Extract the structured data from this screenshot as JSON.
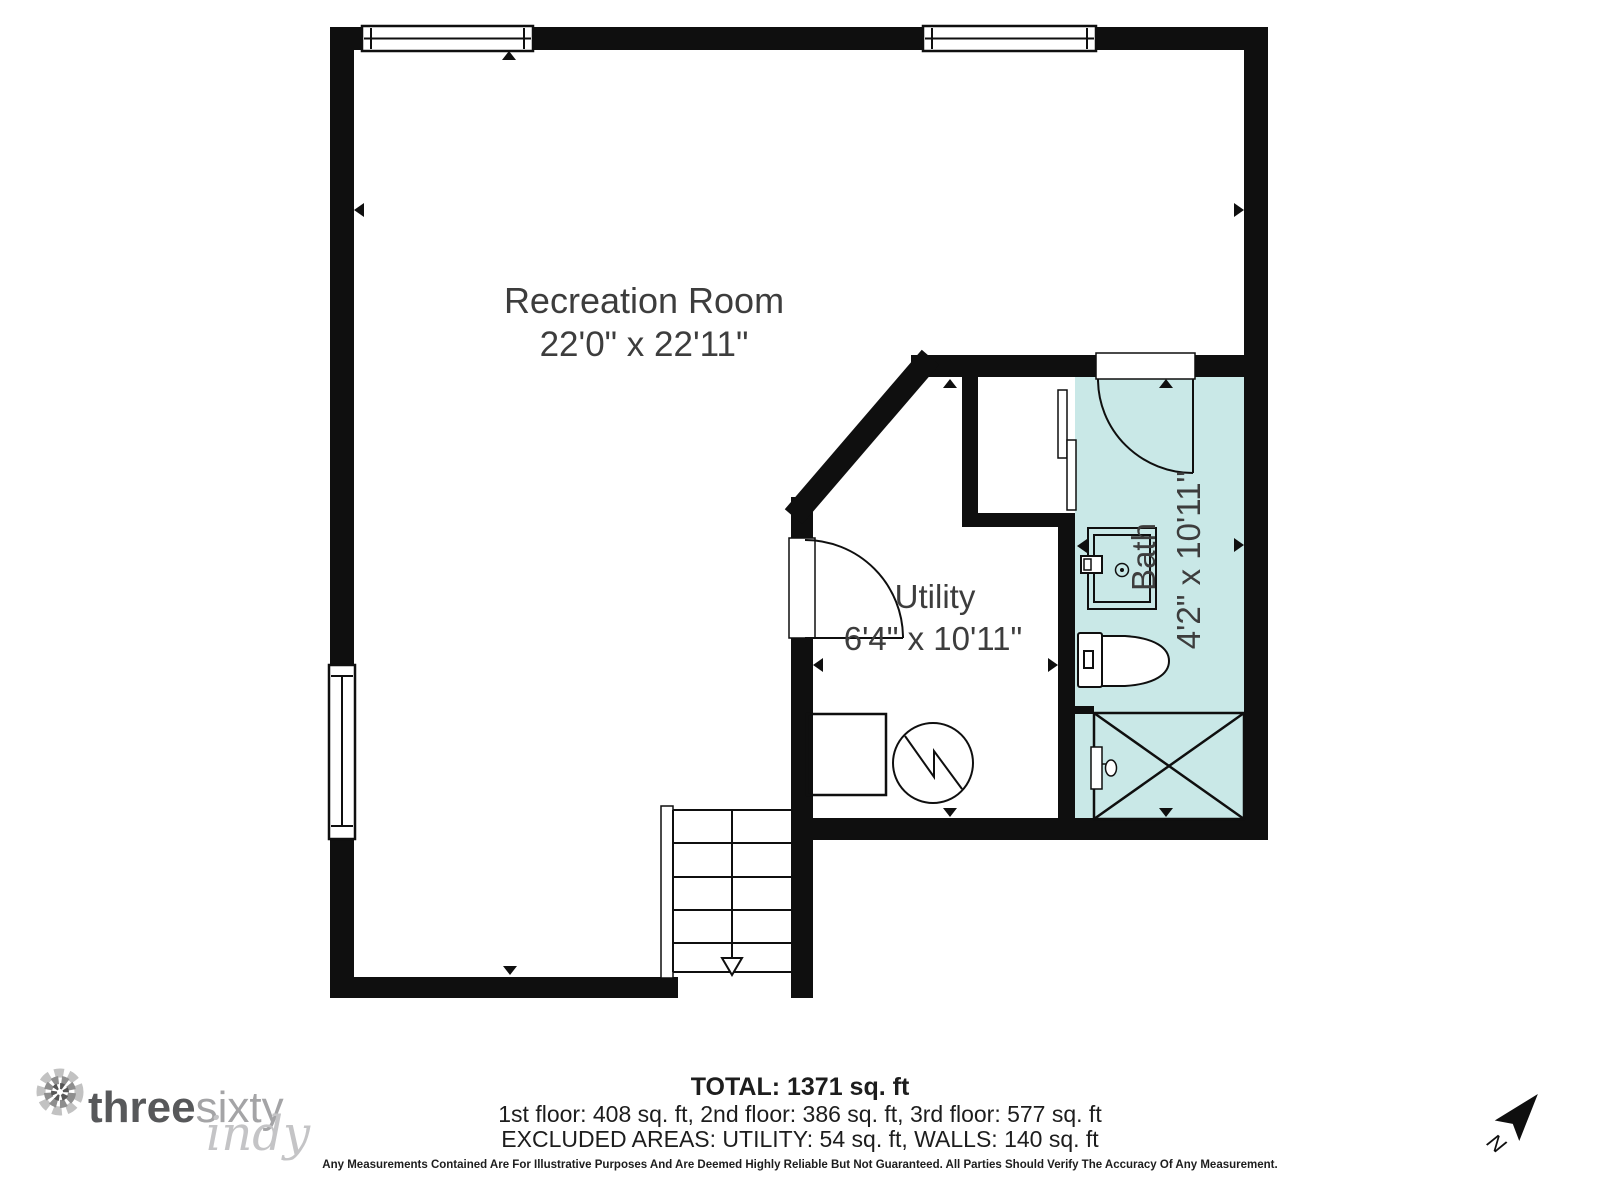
{
  "rooms": {
    "recreation": {
      "name": "Recreation Room",
      "dims": "22'0\" x 22'11\""
    },
    "utility": {
      "name": "Utility",
      "dims": "6'4\" x 10'11\""
    },
    "bath": {
      "name": "Bath",
      "dims": "4'2\" x 10'11\""
    }
  },
  "footer": {
    "total": "TOTAL: 1371 sq. ft",
    "floors": "1st floor: 408 sq. ft, 2nd floor: 386 sq. ft, 3rd floor: 577 sq. ft",
    "excluded": "EXCLUDED AREAS: UTILITY: 54 sq. ft, WALLS: 140 sq. ft",
    "disclaimer": "Any Measurements Contained Are For Illustrative Purposes And Are Deemed Highly Reliable But Not Guaranteed. All Parties Should Verify The Accuracy Of Any Measurement."
  },
  "logo": {
    "word1": "three",
    "word2": "sixty",
    "word3": "indy"
  },
  "compass": {
    "north_label": "N"
  },
  "colors": {
    "wall": "#0f0f0f",
    "bath_fill": "#c9e8e7",
    "label": "#3d3d3d"
  }
}
